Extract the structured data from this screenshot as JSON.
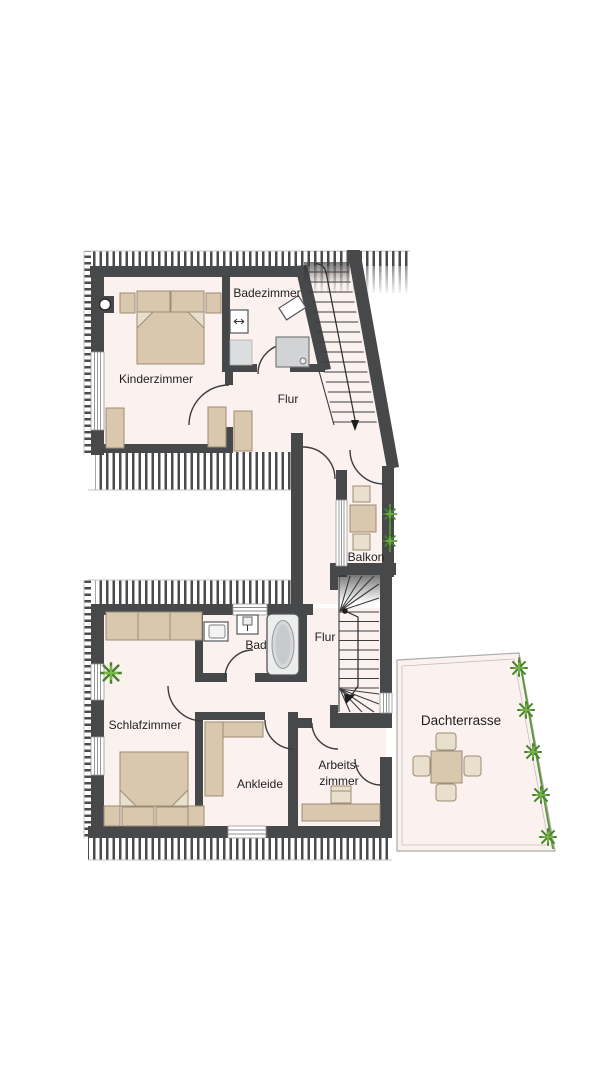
{
  "floorplan": {
    "rooms": {
      "badezimmer": {
        "label": "Badezimmer"
      },
      "kinderzimmer": {
        "label": "Kinderzimmer"
      },
      "flur_upper": {
        "label": "Flur"
      },
      "balkon": {
        "label": "Balkon"
      },
      "bad": {
        "label": "Bad"
      },
      "flur_lower": {
        "label": "Flur"
      },
      "schlafzimmer": {
        "label": "Schlafzimmer"
      },
      "ankleide": {
        "label": "Ankleide"
      },
      "arbeitszimmer": {
        "label_line1": "Arbeits-",
        "label_line2": "zimmer"
      },
      "dachterrasse": {
        "label": "Dachterrasse"
      }
    },
    "colors": {
      "floor": "#fbf1ef",
      "wall": "#47484a",
      "furniture": "#d9c8ae",
      "fixture": "#eceded",
      "plant_green": "#4e8f35",
      "text": "#1f1f1f",
      "roof_hatch_stripe": "#4a4b4d"
    }
  }
}
